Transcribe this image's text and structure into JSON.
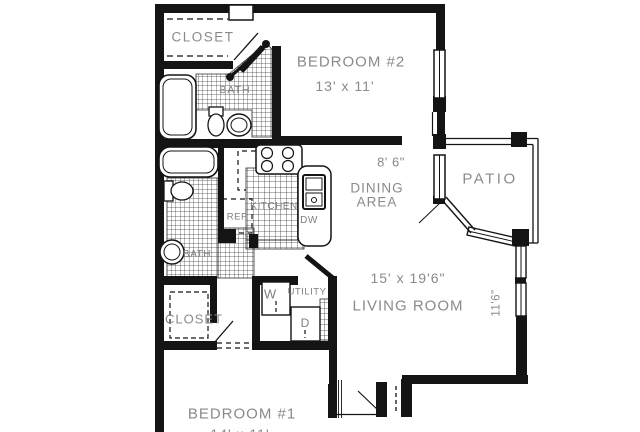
{
  "colors": {
    "wall": "#141414",
    "label": "#8a8a8a",
    "fixture_label": "#7e7e7e",
    "background": "#ffffff"
  },
  "rooms": {
    "closet2": {
      "name": "CLOSET"
    },
    "bedroom2": {
      "name": "BEDROOM #2",
      "dims": "13' x 11'"
    },
    "bath1": {
      "name": "BATH"
    },
    "kitchen": {
      "name": "KITCHEN",
      "ref": "REF",
      "dw": "DW"
    },
    "dining": {
      "width": "8' 6\"",
      "name_line1": "DINING",
      "name_line2": "AREA"
    },
    "patio": {
      "name": "PATIO"
    },
    "living": {
      "name": "LIVING ROOM",
      "dims": "15' x 19'6\"",
      "wall_dim": "11'6\""
    },
    "bath2": {
      "name": "BATH"
    },
    "utility": {
      "name": "UTILITY",
      "washer": "W",
      "dryer": "D"
    },
    "closet1": {
      "name": "CLOSET"
    },
    "bedroom1": {
      "name": "BEDROOM #1",
      "dims": "14' x 11'"
    }
  }
}
